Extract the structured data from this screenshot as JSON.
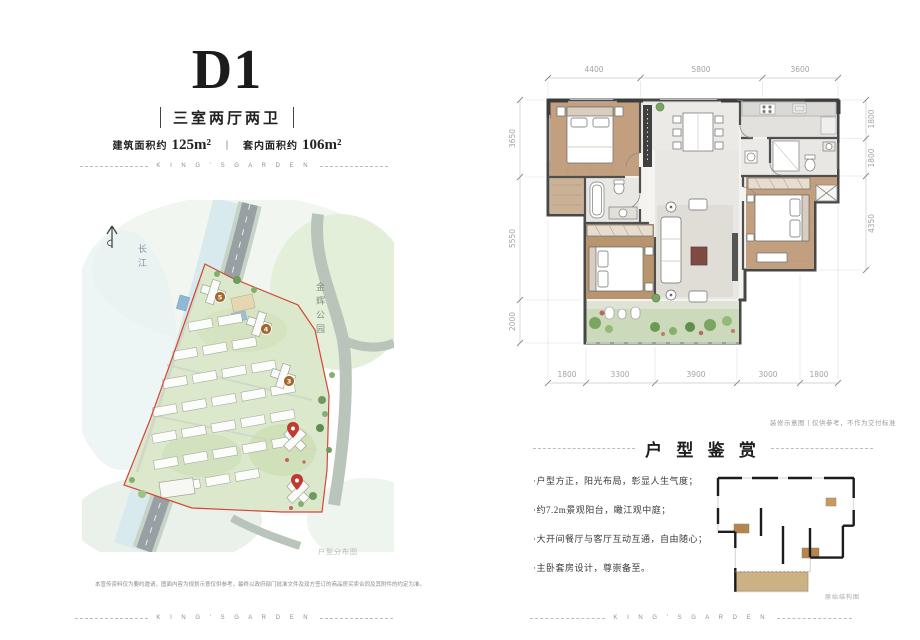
{
  "brand": {
    "name": "K I N G ' S   G A R D E N"
  },
  "palette": {
    "boundary_red": "#d54636",
    "pin_red": "#c13a30",
    "marker_brown": "#a4682d",
    "wood": "#c2a07f",
    "balcony_green": "#ccd9ba",
    "site_green": "#dce8cc"
  },
  "header": {
    "unit_code": "D1",
    "layout_label": "三室两厅两卫",
    "area_items": [
      {
        "prefix": "建筑面积约",
        "value": "125m²"
      },
      {
        "prefix": "套内面积约",
        "value": "106m²"
      }
    ],
    "area_divider": "丨"
  },
  "site_map": {
    "river_label": "长江",
    "park_label": "金辉公园",
    "caption": "户型分布图",
    "markers": [
      {
        "label": "5"
      },
      {
        "label": "4"
      },
      {
        "label": "3"
      }
    ]
  },
  "floor_plan": {
    "dims_top": [
      "4400",
      "5800",
      "3600"
    ],
    "dims_left": [
      "3650",
      "5550",
      "2000"
    ],
    "dims_right": [
      "1800",
      "1800",
      "4350"
    ],
    "dims_bottom": [
      "1800",
      "3300",
      "3900",
      "3000",
      "1800"
    ],
    "note": "装修示意图丨仅供参考，不作为交付标准"
  },
  "appreciation": {
    "title": "户 型 鉴 赏",
    "bullets": [
      "·户型方正，阳光布局，彰显人生气度；",
      "·约7.2m景观阳台，瞰江观中庭；",
      "·大开间餐厅与客厅互动互通，自由随心；",
      "·主卧套房设计，尊崇备至。"
    ],
    "outline_caption": "原始结构图"
  },
  "disclaimer": "本宣传资料仅为要约邀请，图面内容为规划示意仅供参考，最终以政府部门批准文件及双方签订的商品房买卖合同及其附件的约定为准。"
}
